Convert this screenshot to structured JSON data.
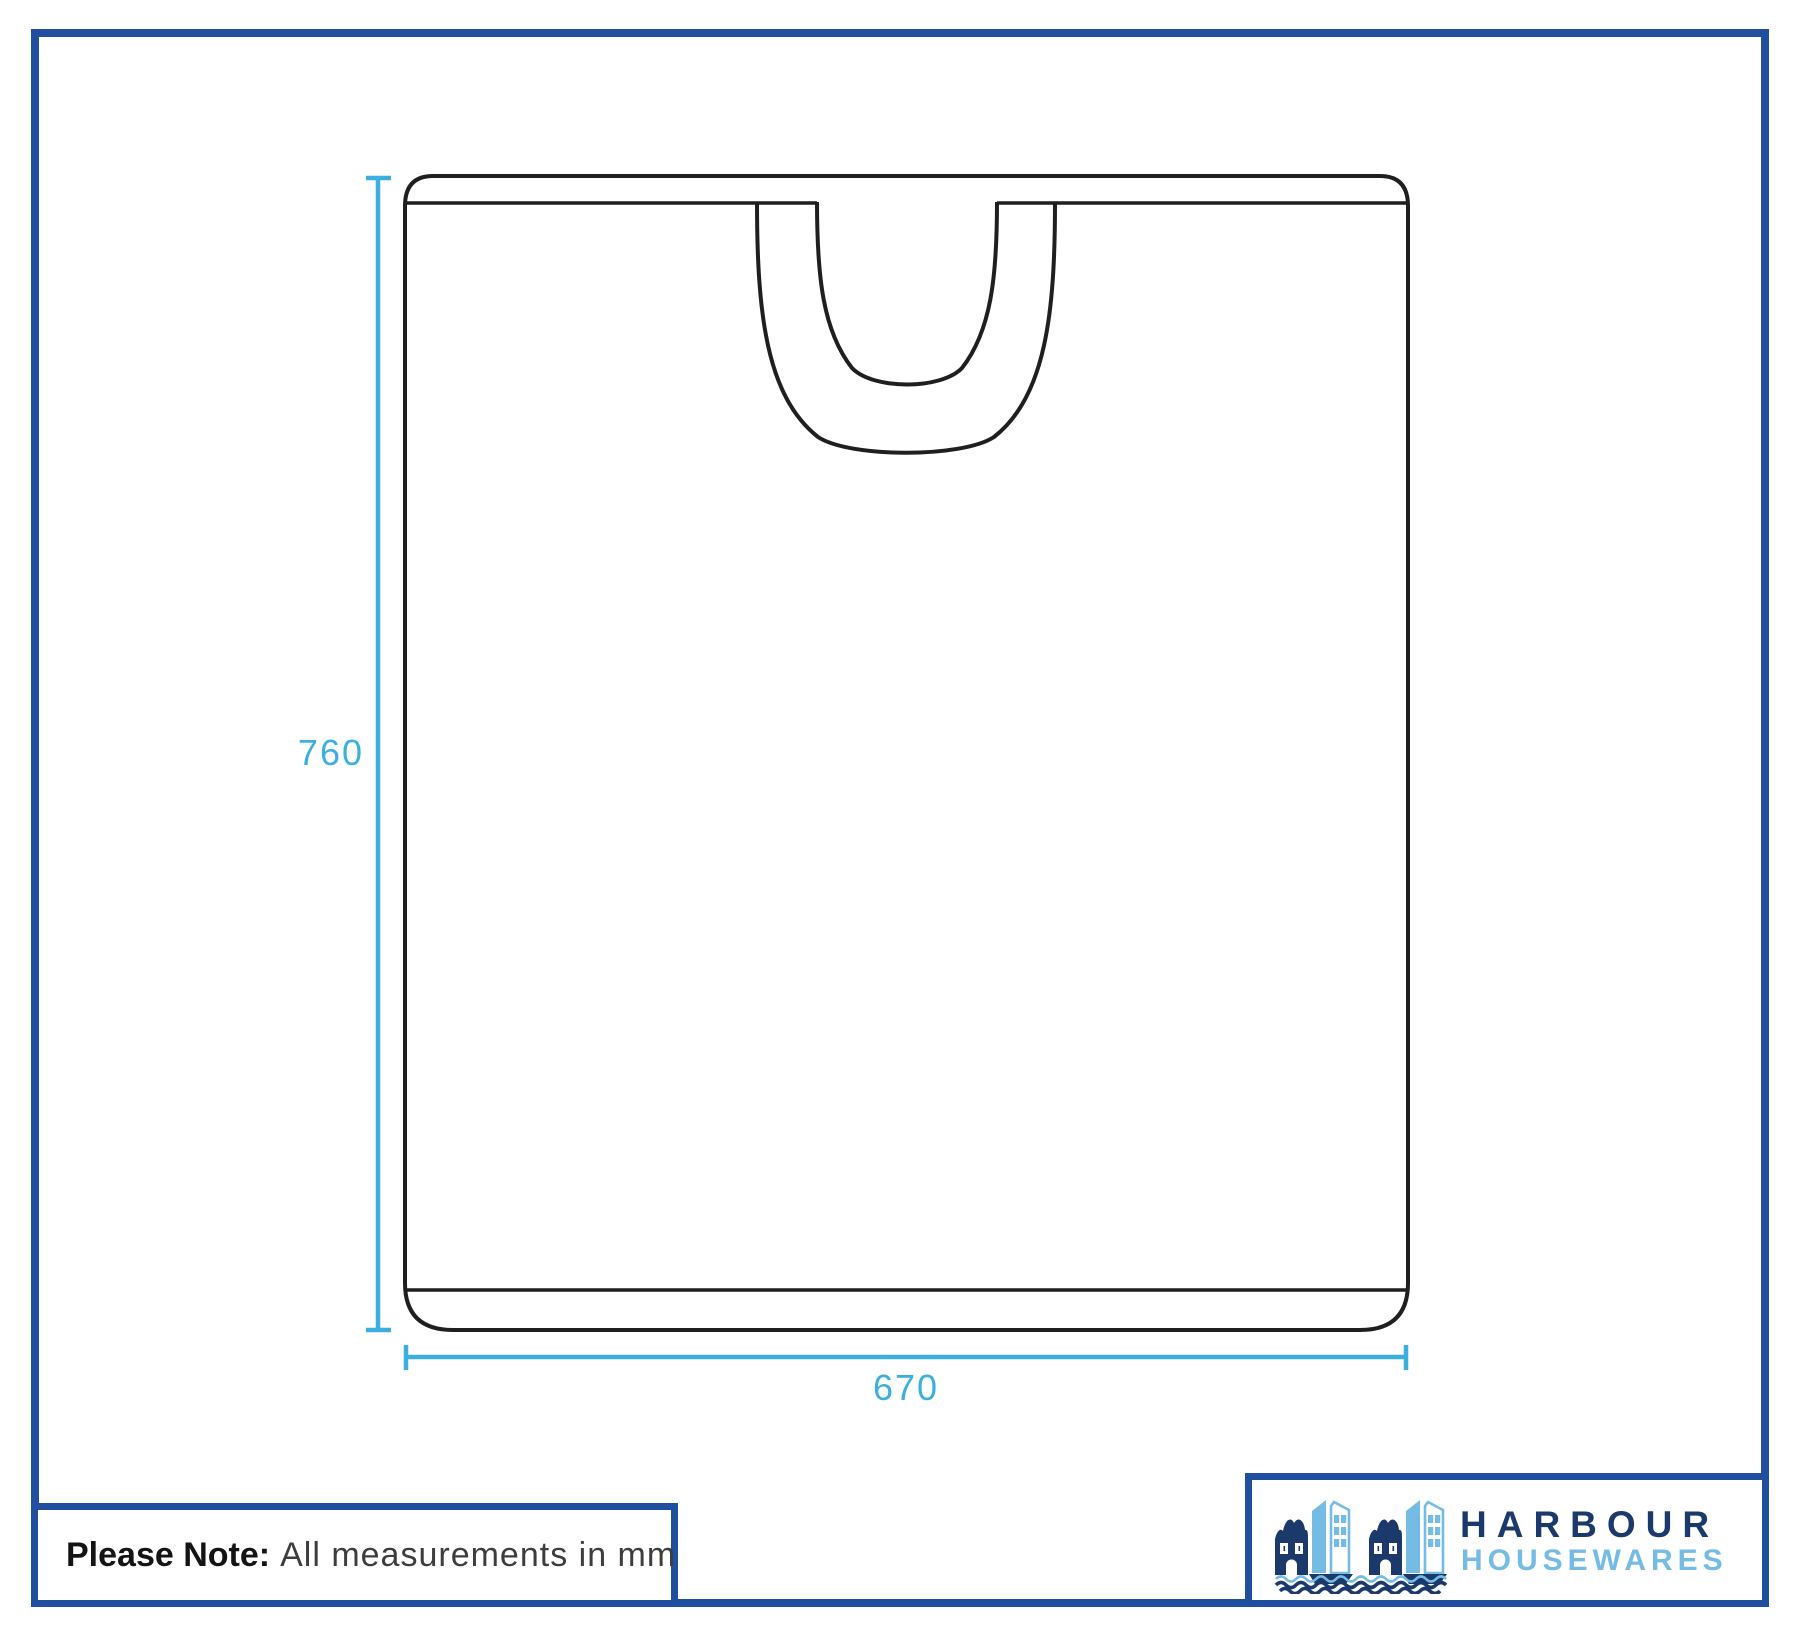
{
  "dimensions": {
    "height_mm": "760",
    "width_mm": "670"
  },
  "note": {
    "prefix": "Please Note:",
    "rest": "All measurements in mm"
  },
  "logo": {
    "line1": "HARBOUR",
    "line2": "HOUSEWARES",
    "icon": "harbour-houses-boats-waves-icon"
  },
  "colors": {
    "frame_blue": "#1F4F9E",
    "dimension_cyan": "#3AAFE0",
    "drawing_ink": "#1F1F1F",
    "logo_navy": "#1B3A6B",
    "logo_light_blue": "#74BCE4",
    "note_bold": "#141414",
    "note_regular": "#3D3D3D"
  }
}
